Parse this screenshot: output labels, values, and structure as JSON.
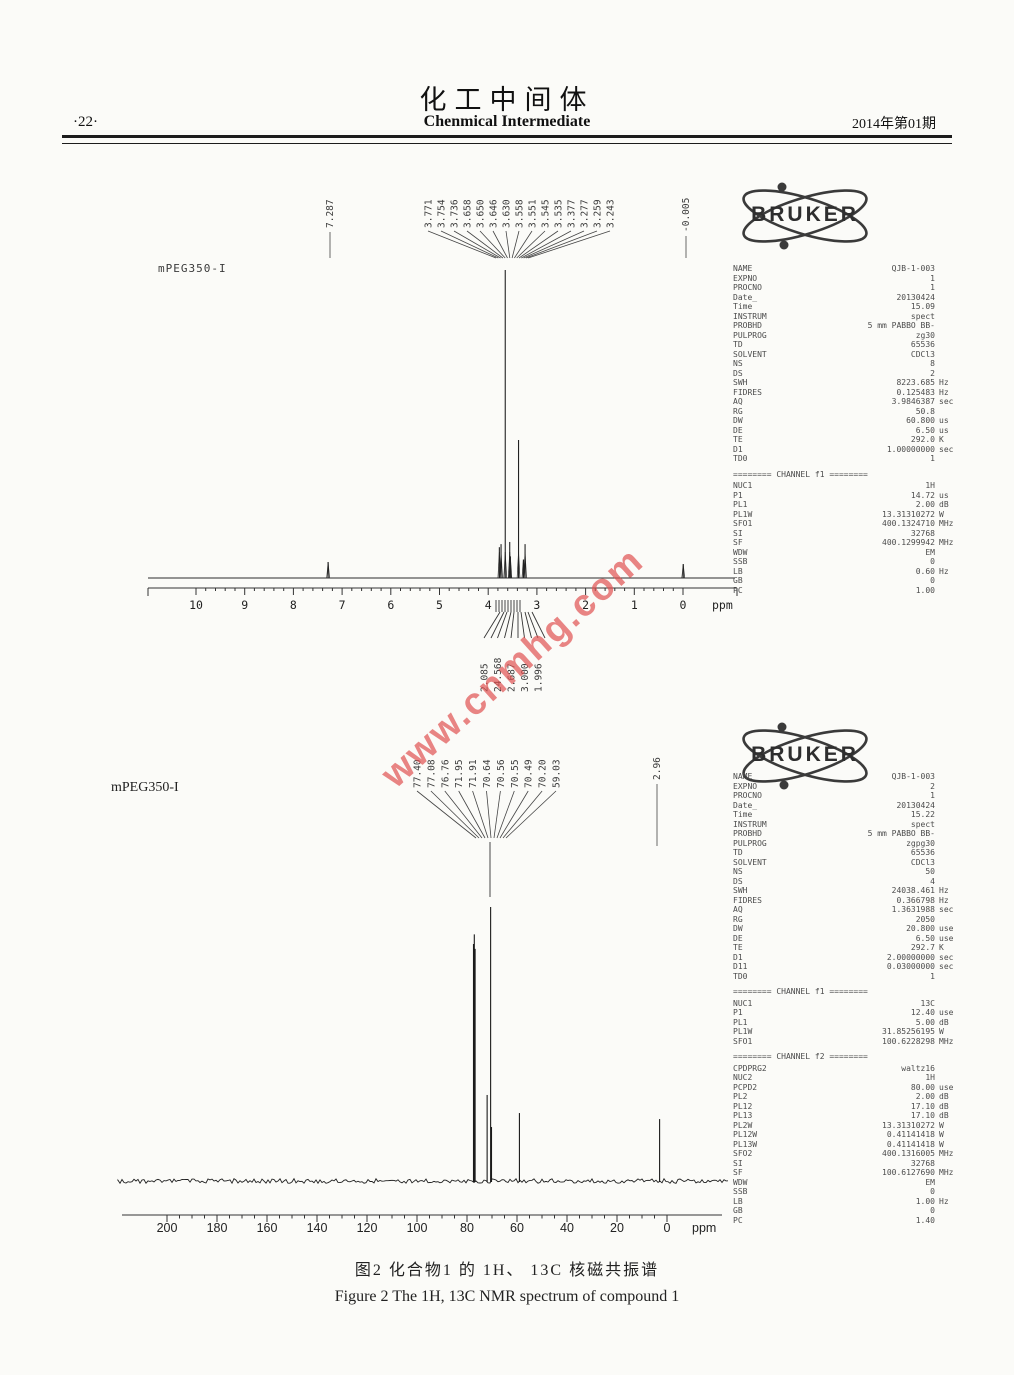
{
  "header": {
    "page_number": "·22·",
    "title_cn": "化工中间体",
    "title_en": "Chenmical Intermediate",
    "issue": "2014年第01期"
  },
  "logo": {
    "text": "BRUKER"
  },
  "watermark": {
    "text": "www.cnmhg.com",
    "color": "#e05252"
  },
  "caption": {
    "cn": "图2 化合物1 的 1H、 13C 核磁共振谱",
    "en": "Figure 2 The 1H, 13C NMR spectrum of compound 1"
  },
  "spectrum_1h": {
    "sample_label": "mPEG350-I",
    "annotations": {
      "left_peak": "7.287",
      "cluster": [
        "3.771",
        "3.754",
        "3.736",
        "3.658",
        "3.650",
        "3.646",
        "3.630",
        "3.558",
        "3.551",
        "3.545",
        "3.535",
        "3.377",
        "3.277",
        "3.259",
        "3.243"
      ],
      "right_peak": "-0.005"
    },
    "integral_labels": [
      "2.085",
      "24.568",
      "2.687",
      "3.000",
      "1.996"
    ],
    "axis": {
      "ticks": [
        "10",
        "9",
        "8",
        "7",
        "6",
        "5",
        "4",
        "3",
        "2",
        "1",
        "0"
      ],
      "unit": "ppm"
    },
    "params": [
      [
        "NAME",
        "QJB-1-003",
        ""
      ],
      [
        "EXPNO",
        "1",
        ""
      ],
      [
        "PROCNO",
        "1",
        ""
      ],
      [
        "Date_",
        "20130424",
        ""
      ],
      [
        "Time",
        "15.09",
        ""
      ],
      [
        "INSTRUM",
        "spect",
        ""
      ],
      [
        "PROBHD",
        "5 mm PABBO BB-",
        ""
      ],
      [
        "PULPROG",
        "zg30",
        ""
      ],
      [
        "TD",
        "65536",
        ""
      ],
      [
        "SOLVENT",
        "CDCl3",
        ""
      ],
      [
        "NS",
        "8",
        ""
      ],
      [
        "DS",
        "2",
        ""
      ],
      [
        "SWH",
        "8223.685",
        "Hz"
      ],
      [
        "FIDRES",
        "0.125483",
        "Hz"
      ],
      [
        "AQ",
        "3.9846387",
        "sec"
      ],
      [
        "RG",
        "50.8",
        ""
      ],
      [
        "DW",
        "60.800",
        "us"
      ],
      [
        "DE",
        "6.50",
        "us"
      ],
      [
        "TE",
        "292.0",
        "K"
      ],
      [
        "D1",
        "1.00000000",
        "sec"
      ],
      [
        "TD0",
        "1",
        ""
      ],
      [
        "#",
        "======== CHANNEL f1 ========",
        ""
      ],
      [
        "NUC1",
        "1H",
        ""
      ],
      [
        "P1",
        "14.72",
        "us"
      ],
      [
        "PL1",
        "2.00",
        "dB"
      ],
      [
        "PL1W",
        "13.31310272",
        "W"
      ],
      [
        "SFO1",
        "400.1324710",
        "MHz"
      ],
      [
        "SI",
        "32768",
        ""
      ],
      [
        "SF",
        "400.1299942",
        "MHz"
      ],
      [
        "WDW",
        "EM",
        ""
      ],
      [
        "SSB",
        "0",
        ""
      ],
      [
        "LB",
        "0.60",
        "Hz"
      ],
      [
        "GB",
        "0",
        ""
      ],
      [
        "PC",
        "1.00",
        ""
      ]
    ]
  },
  "spectrum_13c": {
    "sample_label": "mPEG350-I",
    "annotations": {
      "cluster": [
        "77.40",
        "77.08",
        "76.76",
        "71.95",
        "71.91",
        "70.64",
        "70.56",
        "70.55",
        "70.49",
        "70.20",
        "59.03"
      ],
      "right_peak": "2.96"
    },
    "axis": {
      "ticks": [
        "200",
        "180",
        "160",
        "140",
        "120",
        "100",
        "80",
        "60",
        "40",
        "20",
        "0"
      ],
      "unit": "ppm"
    },
    "params": [
      [
        "NAME",
        "QJB-1-003",
        ""
      ],
      [
        "EXPNO",
        "2",
        ""
      ],
      [
        "PROCNO",
        "1",
        ""
      ],
      [
        "Date_",
        "20130424",
        ""
      ],
      [
        "Time",
        "15.22",
        ""
      ],
      [
        "INSTRUM",
        "spect",
        ""
      ],
      [
        "PROBHD",
        "5 mm PABBO BB-",
        ""
      ],
      [
        "PULPROG",
        "zgpg30",
        ""
      ],
      [
        "TD",
        "65536",
        ""
      ],
      [
        "SOLVENT",
        "CDCl3",
        ""
      ],
      [
        "NS",
        "50",
        ""
      ],
      [
        "DS",
        "4",
        ""
      ],
      [
        "SWH",
        "24038.461",
        "Hz"
      ],
      [
        "FIDRES",
        "0.366798",
        "Hz"
      ],
      [
        "AQ",
        "1.3631988",
        "sec"
      ],
      [
        "RG",
        "2050",
        ""
      ],
      [
        "DW",
        "20.800",
        "use"
      ],
      [
        "DE",
        "6.50",
        "use"
      ],
      [
        "TE",
        "292.7",
        "K"
      ],
      [
        "D1",
        "2.00000000",
        "sec"
      ],
      [
        "D11",
        "0.03000000",
        "sec"
      ],
      [
        "TD0",
        "1",
        ""
      ],
      [
        "#",
        "======== CHANNEL f1 ========",
        ""
      ],
      [
        "NUC1",
        "13C",
        ""
      ],
      [
        "P1",
        "12.40",
        "use"
      ],
      [
        "PL1",
        "5.00",
        "dB"
      ],
      [
        "PL1W",
        "31.85256195",
        "W"
      ],
      [
        "SFO1",
        "100.6228298",
        "MHz"
      ],
      [
        "#",
        "======== CHANNEL f2 ========",
        ""
      ],
      [
        "CPDPRG2",
        "waltz16",
        ""
      ],
      [
        "NUC2",
        "1H",
        ""
      ],
      [
        "PCPD2",
        "80.00",
        "use"
      ],
      [
        "PL2",
        "2.00",
        "dB"
      ],
      [
        "PL12",
        "17.10",
        "dB"
      ],
      [
        "PL13",
        "17.10",
        "dB"
      ],
      [
        "PL2W",
        "13.31310272",
        "W"
      ],
      [
        "PL12W",
        "0.41141418",
        "W"
      ],
      [
        "PL13W",
        "0.41141418",
        "W"
      ],
      [
        "SFO2",
        "400.1316005",
        "MHz"
      ],
      [
        "SI",
        "32768",
        ""
      ],
      [
        "SF",
        "100.6127690",
        "MHz"
      ],
      [
        "WDW",
        "EM",
        ""
      ],
      [
        "SSB",
        "0",
        ""
      ],
      [
        "LB",
        "1.00",
        "Hz"
      ],
      [
        "GB",
        "0",
        ""
      ],
      [
        "PC",
        "1.40",
        ""
      ]
    ]
  },
  "chart_data": [
    {
      "type": "line",
      "subtype": "1H NMR",
      "title": "mPEG350-I 1H NMR (400 MHz, CDCl3)",
      "xlabel": "ppm",
      "x_ticks": [
        10,
        9,
        8,
        7,
        6,
        5,
        4,
        3,
        2,
        1,
        0
      ],
      "peak_ppm_labels": [
        7.287,
        3.771,
        3.754,
        3.736,
        3.658,
        3.65,
        3.646,
        3.63,
        3.558,
        3.551,
        3.545,
        3.535,
        3.377,
        3.277,
        3.259,
        3.243,
        -0.005
      ],
      "integrals": [
        2.085,
        24.568,
        2.687,
        3.0,
        1.996
      ],
      "peaks": [
        [
          7.287,
          0.052
        ],
        [
          3.771,
          0.1
        ],
        [
          3.736,
          0.11
        ],
        [
          3.65,
          1.0
        ],
        [
          3.558,
          0.117
        ],
        [
          3.545,
          0.07
        ],
        [
          3.377,
          0.448
        ],
        [
          3.277,
          0.06
        ],
        [
          3.243,
          0.11
        ],
        [
          -0.005,
          0.045
        ]
      ]
    },
    {
      "type": "line",
      "subtype": "13C NMR",
      "title": "mPEG350-I 13C NMR (100 MHz, CDCl3)",
      "xlabel": "ppm",
      "x_ticks": [
        200,
        180,
        160,
        140,
        120,
        100,
        80,
        60,
        40,
        20,
        0
      ],
      "peak_ppm_labels": [
        77.4,
        77.08,
        76.76,
        71.95,
        71.91,
        70.64,
        70.56,
        70.55,
        70.49,
        70.2,
        59.03,
        2.96
      ],
      "peaks": [
        [
          77.4,
          0.865
        ],
        [
          77.08,
          0.9
        ],
        [
          76.76,
          0.847
        ],
        [
          71.95,
          0.314
        ],
        [
          70.55,
          1.0
        ],
        [
          70.2,
          0.197
        ],
        [
          59.03,
          0.248
        ],
        [
          2.96,
          0.226
        ]
      ]
    }
  ]
}
